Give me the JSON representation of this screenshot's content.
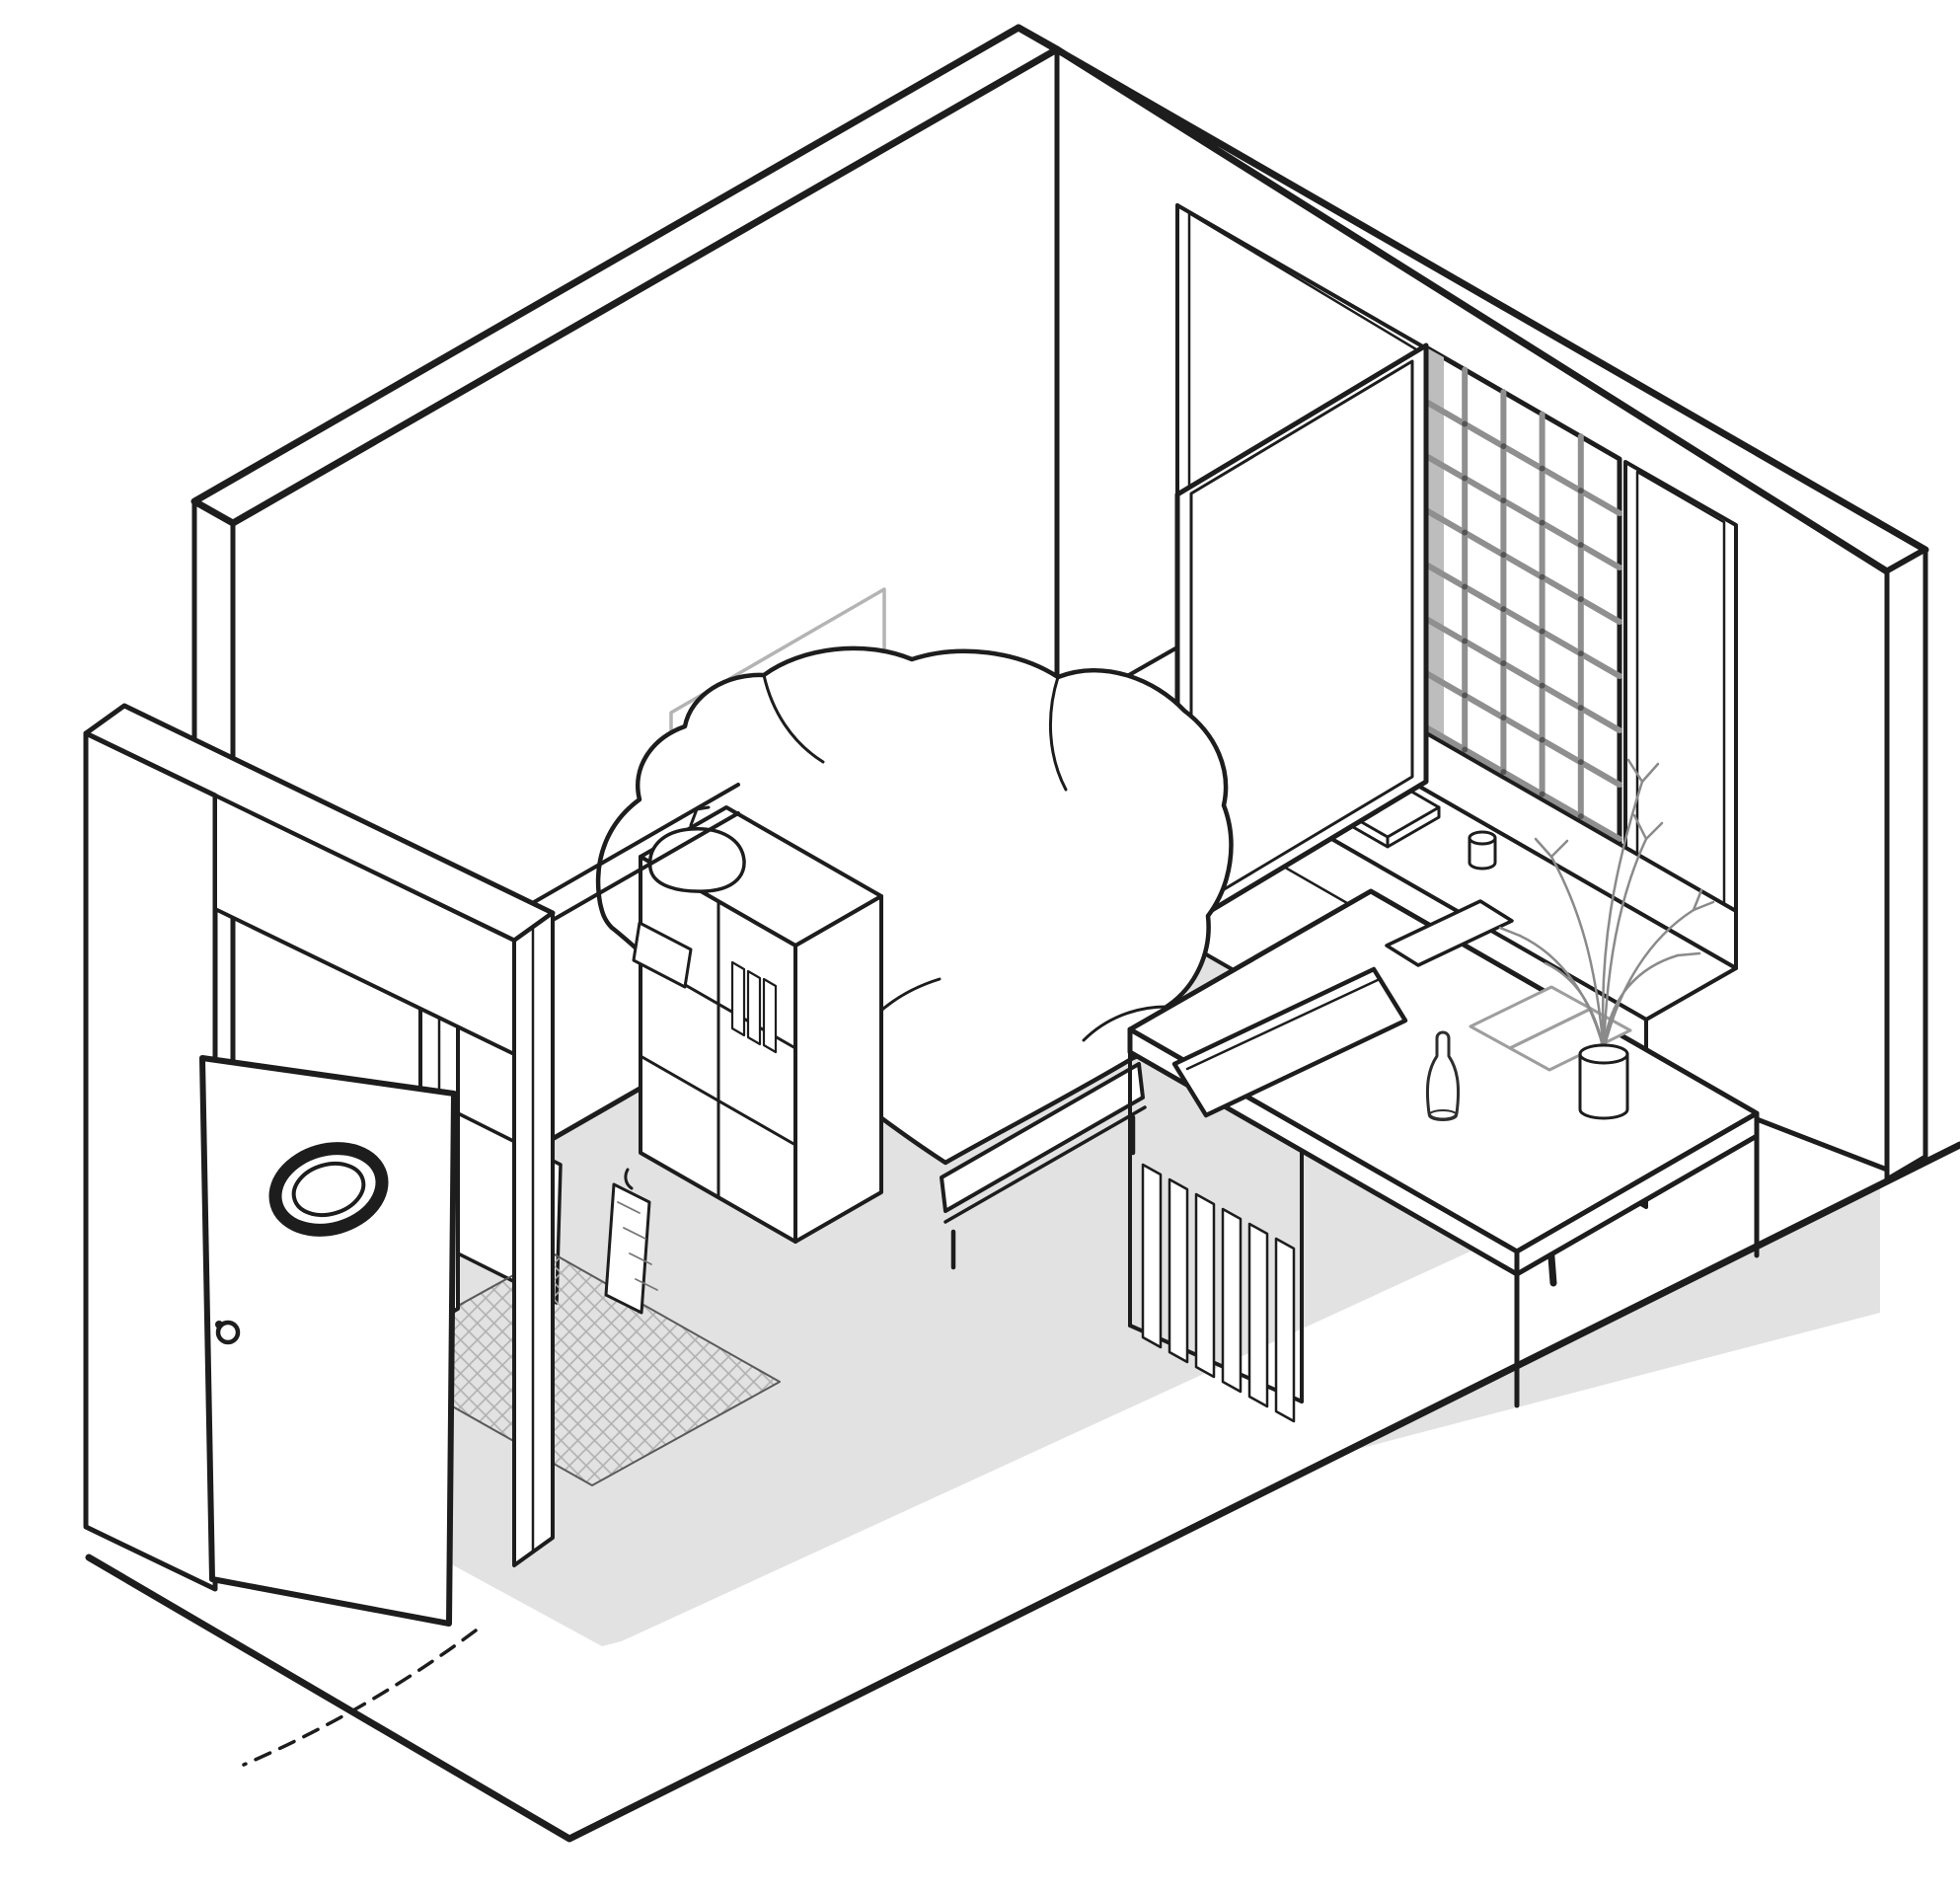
{
  "meta": {
    "description": "Isometric cutaway line drawing of a compact single room: open entry door with porthole window, bathroom corner with basin, mirror panel, hanging towel and hatched shower floor, single bed with rumpled duvet, framed picture and outlet on the back wall, gridded window with an open casement panel, window bench with a book and cup, writing desk with open book, tablet, bottle and plant in a vase, desk chair, gray floor slab"
  },
  "colors": {
    "background": "#ffffff",
    "ink": "#1d1d1d",
    "floor": "#e2e2e2",
    "hatch": "#b0b0b0",
    "mullion": "#8f8f8f",
    "reveal": "#bdbdbd",
    "softGray": "#9e9e9e",
    "pictureGray": "#b4b4b4",
    "plantGray": "#8a8a8a",
    "detailGray": "#a3a3a3",
    "tileEdge": "#5a5a5a"
  },
  "elements": {
    "room": "room-shell",
    "door": "entry-door",
    "porthole": "porthole-window",
    "knob": "door-knob",
    "swing": "door-swing-arc",
    "bed": "bed-with-duvet",
    "picture": "wall-picture",
    "outlet": "wall-outlet",
    "window": "grid-window",
    "casement": "open-casement-panel",
    "bench": "window-bench",
    "book": "book-on-bench",
    "cup": "cup-on-bench",
    "desk": "writing-desk",
    "openBook": "open-book-on-desk",
    "tablet": "tablet-on-desk",
    "bottle": "bottle-on-desk",
    "plant": "plant-in-vase",
    "chair": "desk-chair",
    "vanity": "vanity-cabinet-with-sink",
    "towel": "hanging-towel",
    "mirror": "mirror-panel",
    "shower": "tiled-shower-floor"
  }
}
